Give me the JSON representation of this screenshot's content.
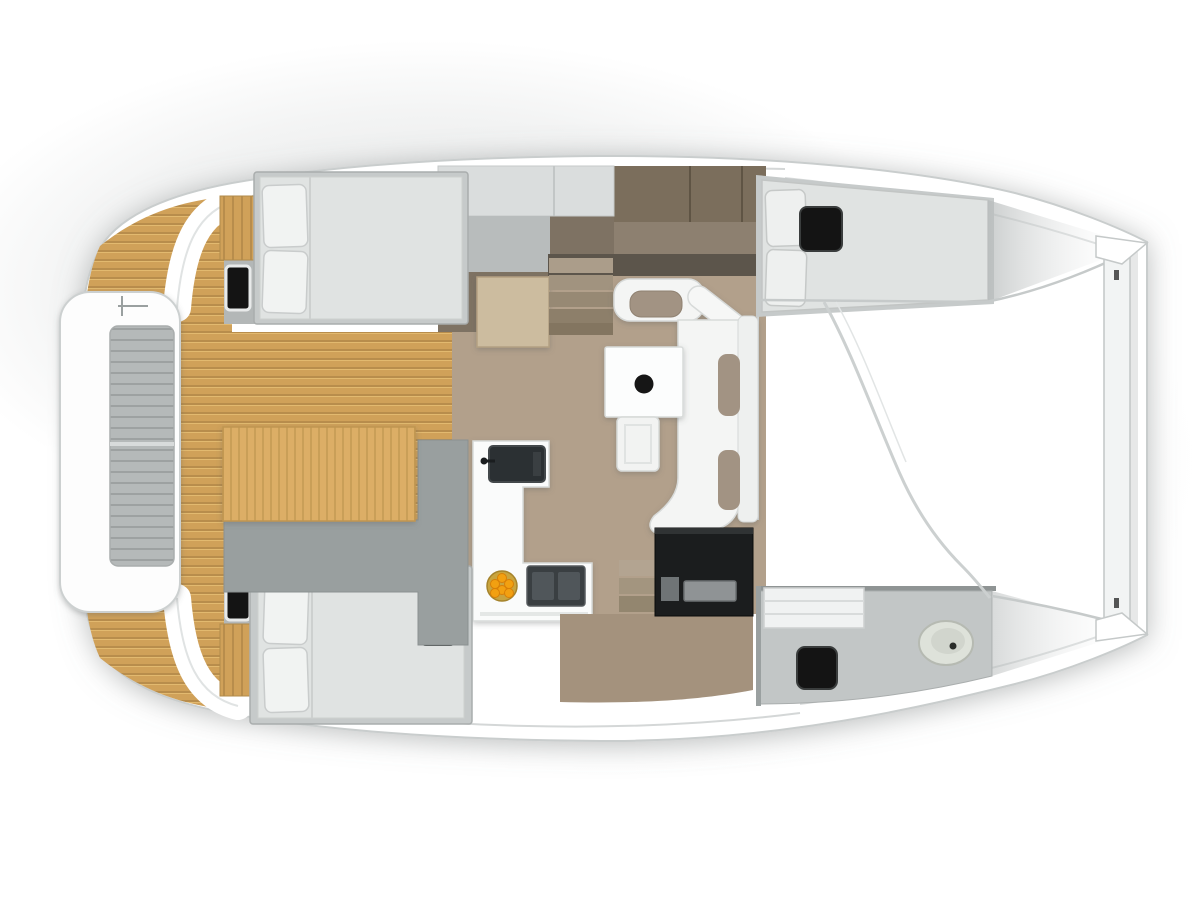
{
  "scene": {
    "type": "yacht-floorplan",
    "subject": "catamaran interior layout, top-down 3D render, no text labels",
    "orientation": {
      "bow": "right",
      "stern": "left"
    },
    "background": "#ffffff"
  },
  "palette": {
    "outline": "#c9cdcd",
    "hull_white": "#ffffff",
    "deck_shade": "#c8cccc",
    "teak_base": "#d0a159",
    "teak_stripe": "#b88d4c",
    "sunpad_base": "#dcae66",
    "sunpad_stripe": "#c99f58",
    "platform_slats": "#b5b9b9",
    "platform_slat_line": "#9da1a1",
    "bench_gray": "#999f9f",
    "saloon_floor": "#b2a08b",
    "hull_floor": "#7e7263",
    "corridor_floor": "#a4927d",
    "cabinet_dark_top": "#7b6e5c",
    "cabinet_dark_low": "#8d8070",
    "cabinet_light": "#dadddd",
    "cabinet_gray": "#b8bcbc",
    "wardrobe_beige": "#ccbc9f",
    "bed_frame": "#c6caca",
    "mattress": "#e0e3e2",
    "pillow": "#f1f3f2",
    "accent_cushion": "#a29383",
    "sofa_white": "#f4f5f4",
    "table_white": "#fcfdfd",
    "hatch_black": "#141414",
    "bulkhead_dark": "#5c554b",
    "counter_white": "#fafbfb",
    "sink_dark": "#2b3033",
    "stove_dark": "#3a3f42",
    "stove_burner": "#50565a",
    "fruit_bowl": "#c9a43e",
    "fruit": "#f2a011",
    "desk_black": "#1b1d1e",
    "desk_drawer": "#8f9395",
    "bath_floor": "#c2c6c6",
    "toilet": "#dee2da",
    "toilet_inner": "#d1d5cd",
    "beam_white": "#f2f4f4",
    "floor_strip_gray": "#b3b7b7",
    "step_1": "#ab9d8a",
    "step_2": "#a1937f",
    "step_3": "#978974",
    "step_4": "#8d7f6a",
    "step_5": "#837560"
  },
  "inventory": {
    "stern_platform": {
      "items": [
        "slatted-bench-platform"
      ]
    },
    "cockpit": {
      "deck": "teak-planking",
      "items": [
        "wooden-cockpit-table",
        "gray-bench-seat"
      ]
    },
    "port_hull_aft_cabin": {
      "items": [
        "double-bed",
        "two-pillows",
        "black-deck-hatch",
        "wood-step-cabinet"
      ]
    },
    "port_hull_midship": {
      "items": [
        "light-lockers",
        "open-wardrobe-door",
        "companionway-stairs",
        "dark-cabinet-band"
      ]
    },
    "port_hull_forward_cabin": {
      "items": [
        "double-berth",
        "two-pillows",
        "black-deck-hatch"
      ]
    },
    "saloon": {
      "items": [
        "square-dining-table-with-pedestal",
        "l-shaped-sofa",
        "taupe-seat-cushions",
        "stool-bench"
      ]
    },
    "galley": {
      "items": [
        "l-shaped-counter",
        "dark-sink-with-faucet",
        "two-burner-stove",
        "fruit-bowl",
        "black-appliance-unit",
        "companionway-stairs"
      ]
    },
    "starboard_hull_aft_cabin": {
      "items": [
        "double-bed",
        "two-pillows",
        "black-mattress-hatch",
        "black-deck-hatch",
        "wood-step-cabinet"
      ]
    },
    "starboard_hull_bathroom": {
      "items": [
        "vanity-counter",
        "toilet",
        "black-deck-hatch",
        "gray-shower-floor"
      ]
    },
    "foredeck": {
      "items": [
        "trampoline-area",
        "forward-crossbeam",
        "bow-tips"
      ]
    }
  }
}
